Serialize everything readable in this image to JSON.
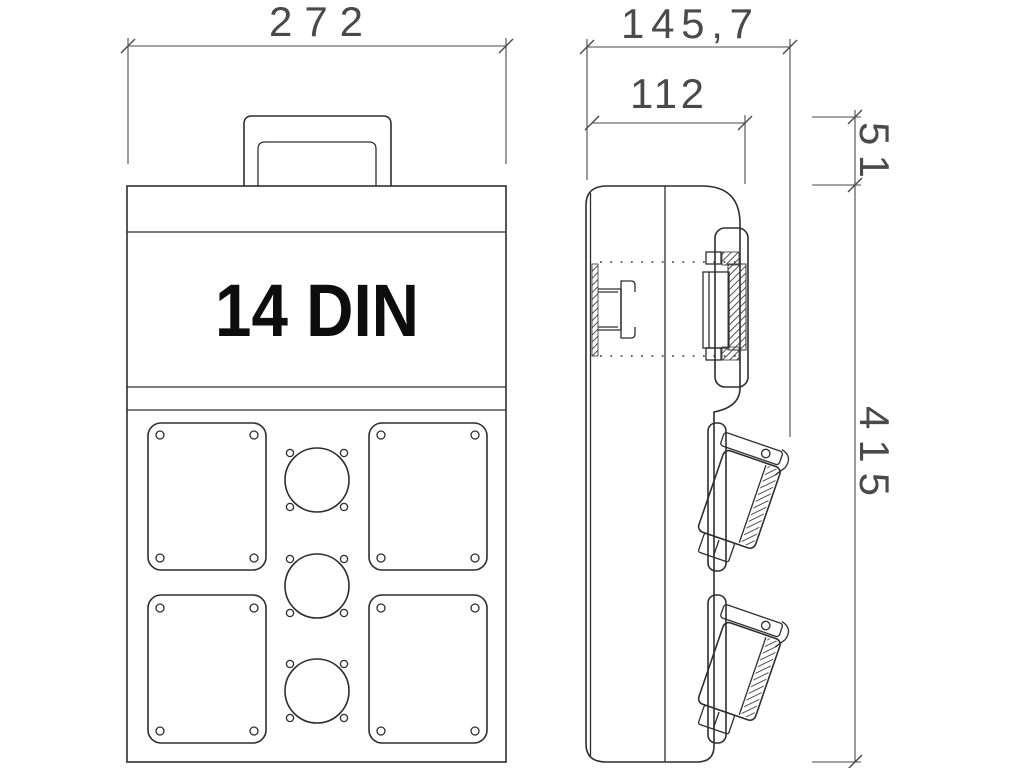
{
  "drawing": {
    "type": "technical-dimension-drawing",
    "background": "#ffffff",
    "colors": {
      "line": "#2e2e2e",
      "dimension_text": "#4a4a4a",
      "label_text": "#0d0d0d",
      "hatch": "#3d3d3d"
    },
    "front_view": {
      "panel_label": "14 DIN",
      "width_dimension": "272",
      "socket_plates_count": 4,
      "cable_gland_circles_count": 3
    },
    "side_view": {
      "overall_depth_dimension": "145,7",
      "body_depth_dimension": "112",
      "lid_height_dimension": "51",
      "overall_height_dimension": "415",
      "side_sockets_count": 2
    }
  }
}
